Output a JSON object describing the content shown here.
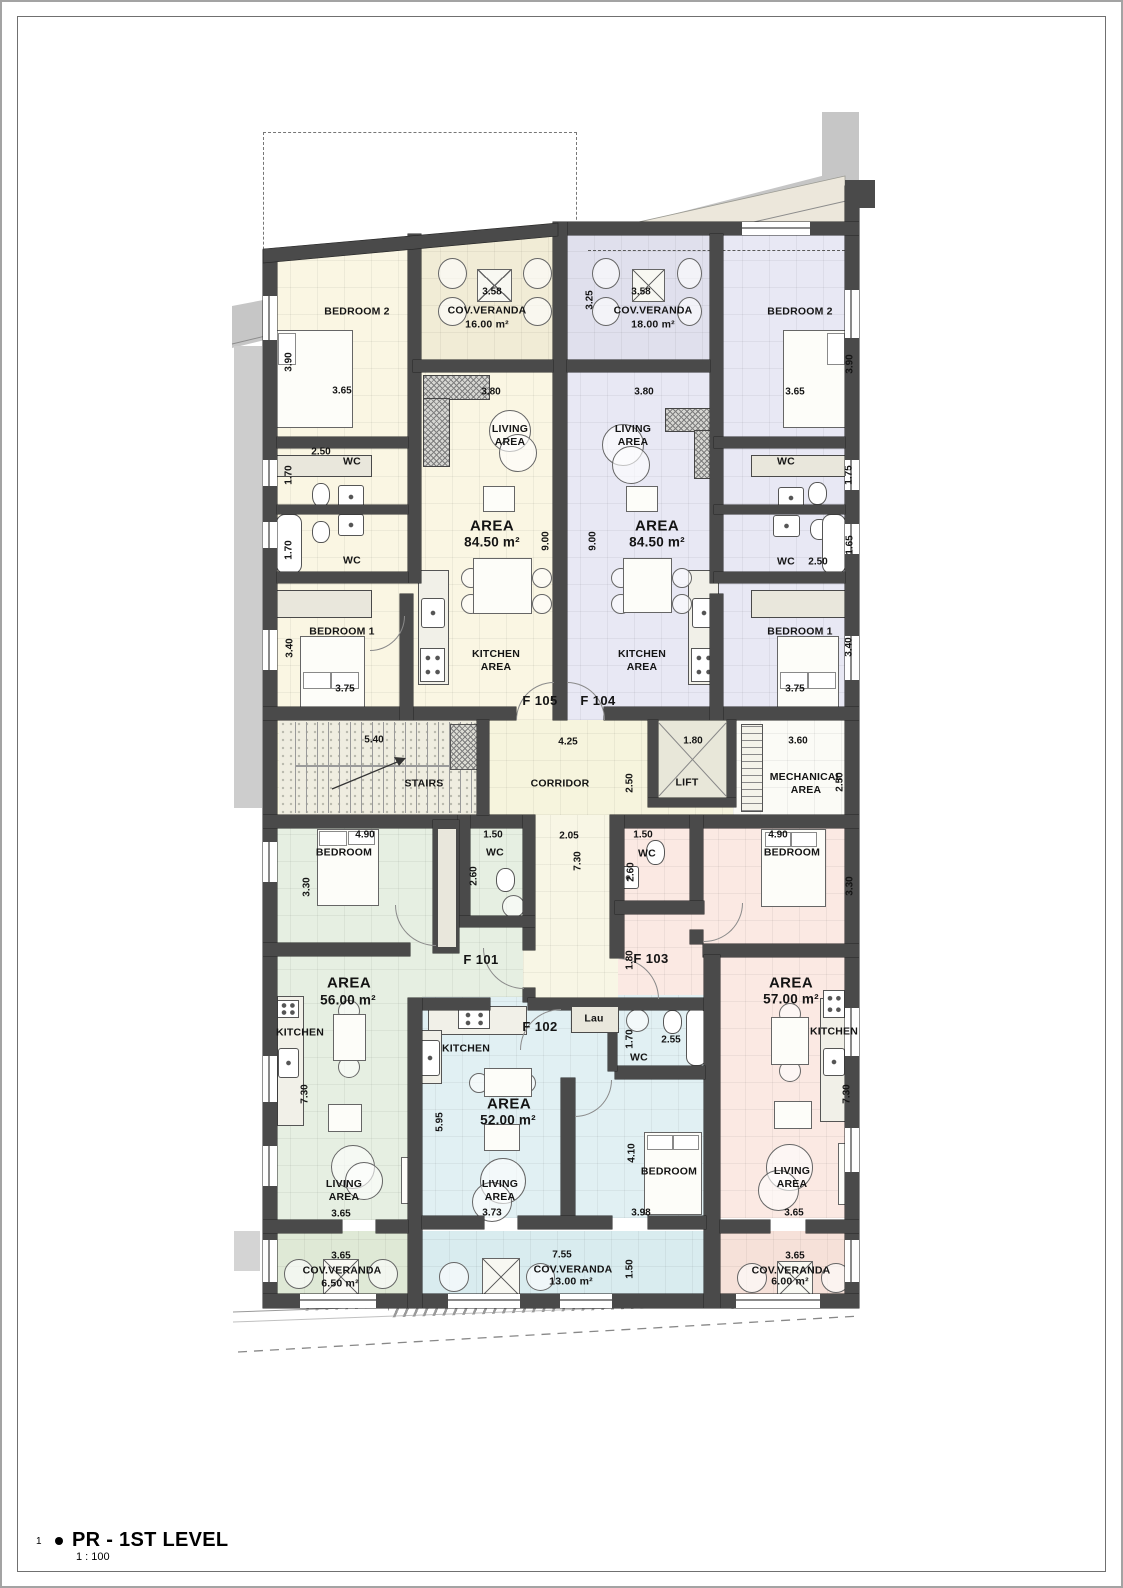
{
  "title_block": {
    "index": "1",
    "title": "PR - 1ST LEVEL",
    "scale": "1 : 100"
  },
  "colors": {
    "f105": "#faf6e3",
    "f104": "#e8e8f4",
    "f101": "#e6efe2",
    "f102": "#e1f0f3",
    "f103": "#fbe9e3",
    "core": "#f6f4dd",
    "wall": "#4a4a4a",
    "shadow": "#c7c7c7"
  },
  "core": {
    "stairs": "STAIRS",
    "corridor": "CORRIDOR",
    "lift": "LIFT",
    "mechanical": "MECHANICAL\nAREA",
    "dims": {
      "stairs_w": "5.40",
      "corridor_w": "4.25",
      "corridor_d": "2.50",
      "lift_w": "1.80",
      "mech_w": "3.60",
      "mech_d": "2.50",
      "lobby_w": "2.05",
      "lobby_d": "7.30"
    }
  },
  "apartments": {
    "f105": {
      "id": "F 105",
      "area_title": "AREA",
      "area_value": "84.50 m²",
      "bedroom2": "BEDROOM 2",
      "bedroom1": "BEDROOM 1",
      "veranda": "COV.VERANDA",
      "veranda_area": "16.00 m²",
      "living": "LIVING\nAREA",
      "kitchen": "KITCHEN\nAREA",
      "wc_upper": "WC",
      "wc_lower": "WC",
      "dims": {
        "veranda_w": "3.58",
        "bed2_h": "3.90",
        "bed2_w": "3.65",
        "living_w": "3.80",
        "wc_w": "2.50",
        "wc_upper_h": "1.70",
        "wc_lower_h": "1.70",
        "depth": "9.00",
        "bed1_h": "3.40",
        "bed1_w": "3.75"
      }
    },
    "f104": {
      "id": "F 104",
      "area_title": "AREA",
      "area_value": "84.50 m²",
      "bedroom2": "BEDROOM 2",
      "bedroom1": "BEDROOM 1",
      "veranda": "COV.VERANDA",
      "veranda_area": "18.00 m²",
      "living": "LIVING\nAREA",
      "kitchen": "KITCHEN\nAREA",
      "wc_upper": "WC",
      "wc_lower": "WC",
      "dims": {
        "veranda_w": "3.58",
        "veranda_d": "3.25",
        "bed2_h": "3.90",
        "bed2_w": "3.65",
        "living_w": "3.80",
        "wc_upper_h": "1.75",
        "wc_lower_h": "1.65",
        "wc_w": "2.50",
        "depth": "9.00",
        "bed1_h": "3.40",
        "bed1_w": "3.75"
      }
    },
    "f101": {
      "id": "F 101",
      "area_title": "AREA",
      "area_value": "56.00 m²",
      "bedroom": "BEDROOM",
      "wc": "WC",
      "kitchen": "KITCHEN",
      "living": "LIVING\nAREA",
      "veranda": "COV.VERANDA",
      "veranda_area": "6.50 m²",
      "dims": {
        "bed_w": "4.90",
        "bed_h": "3.30",
        "wc_w": "1.50",
        "wc_h": "2.60",
        "kitchen_h": "7.30",
        "living_w": "3.65",
        "veranda_w": "3.65"
      }
    },
    "f102": {
      "id": "F 102",
      "area_title": "AREA",
      "area_value": "52.00 m²",
      "bedroom": "BEDROOM",
      "wc": "WC",
      "laundry": "Lau",
      "kitchen": "KITCHEN",
      "living": "LIVING\nAREA",
      "veranda": "COV.VERANDA",
      "veranda_area": "13.00 m²",
      "dims": {
        "kitchen_h": "5.95",
        "living_w": "3.73",
        "bed_h": "4.10",
        "bed_w": "3.98",
        "wc_h": "1.70",
        "wc_w": "2.55",
        "veranda_w": "7.55",
        "veranda_h": "1.50"
      }
    },
    "f103": {
      "id": "F 103",
      "area_title": "AREA",
      "area_value": "57.00 m²",
      "bedroom": "BEDROOM",
      "wc": "WC",
      "kitchen": "KITCHEN",
      "living": "LIVING\nAREA",
      "veranda": "COV.VERANDA",
      "veranda_area": "6.00 m²",
      "dims": {
        "wc_w": "1.50",
        "wc_h": "2.60",
        "bed_w": "4.90",
        "bed_h": "3.30",
        "entry_h": "1.80",
        "kitchen_h": "7.30",
        "living_w": "3.65",
        "veranda_w": "3.65"
      }
    }
  }
}
